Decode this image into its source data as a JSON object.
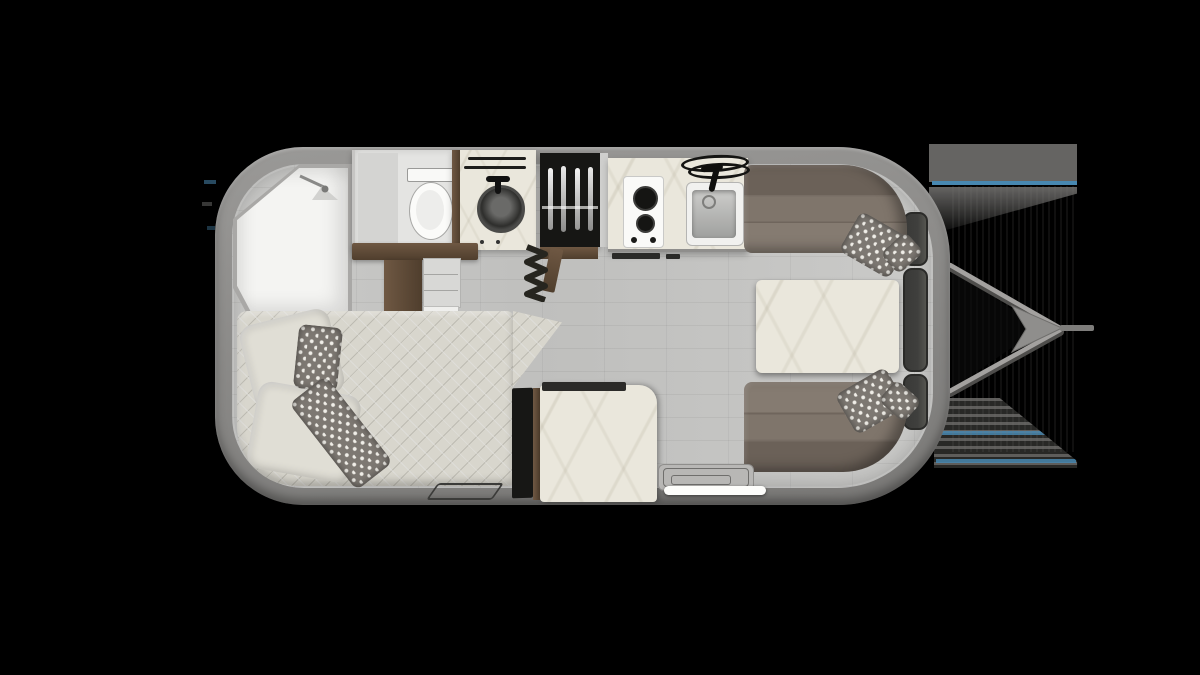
{
  "scene": {
    "type": "travel-trailer-floorplan",
    "view": "top-down",
    "visible_text": [],
    "background": "#000000"
  },
  "palette": {
    "bg": "#000000",
    "shellLight": "#9a9997",
    "shell": "#8f8e8c",
    "shellDark": "#7a7977",
    "wall": "#a9a8a6",
    "floor": "#c7c7c5",
    "white": "#f4f4f2",
    "roomGray": "#e4e4e2",
    "marble": "#eae7dc",
    "wood": "#6f5843",
    "woodDark": "#4f3e2d",
    "benchBack": "#6b6158",
    "benchSeat": "#7f756b",
    "mattress": "#d8d6cd",
    "pillow": "#e0ded5",
    "pillowPattern": "#7d7872",
    "pillowDot": "#f0eee8",
    "black": "#161614",
    "glass": "#3f3f3d",
    "steel": "#a3a19f",
    "blue": "#4f94c0",
    "artifact": "#6e6d6b"
  },
  "floorplan": {
    "shell": "rounded travel-trailer body, hitch on right",
    "features": [
      "shower-room",
      "shower-head",
      "toilet",
      "vanity-round-sink",
      "vanity-towel-bars",
      "hanging-wardrobe",
      "accordion-door",
      "wood-cabinet",
      "two-burner-cooktop",
      "kitchen-sink",
      "kitchen-towel-rings",
      "kitchen-counter",
      "bed-with-pillows",
      "bedroom-window",
      "floor-mat",
      "tv-panel",
      "marble-cabinet",
      "entry-step",
      "entry-grab-handle",
      "dinette-front-bench",
      "dinette-rear-bench",
      "dinette-table",
      "dinette-pillows",
      "sidewall-windows",
      "a-frame-hitch",
      "hitch-tongue"
    ]
  }
}
